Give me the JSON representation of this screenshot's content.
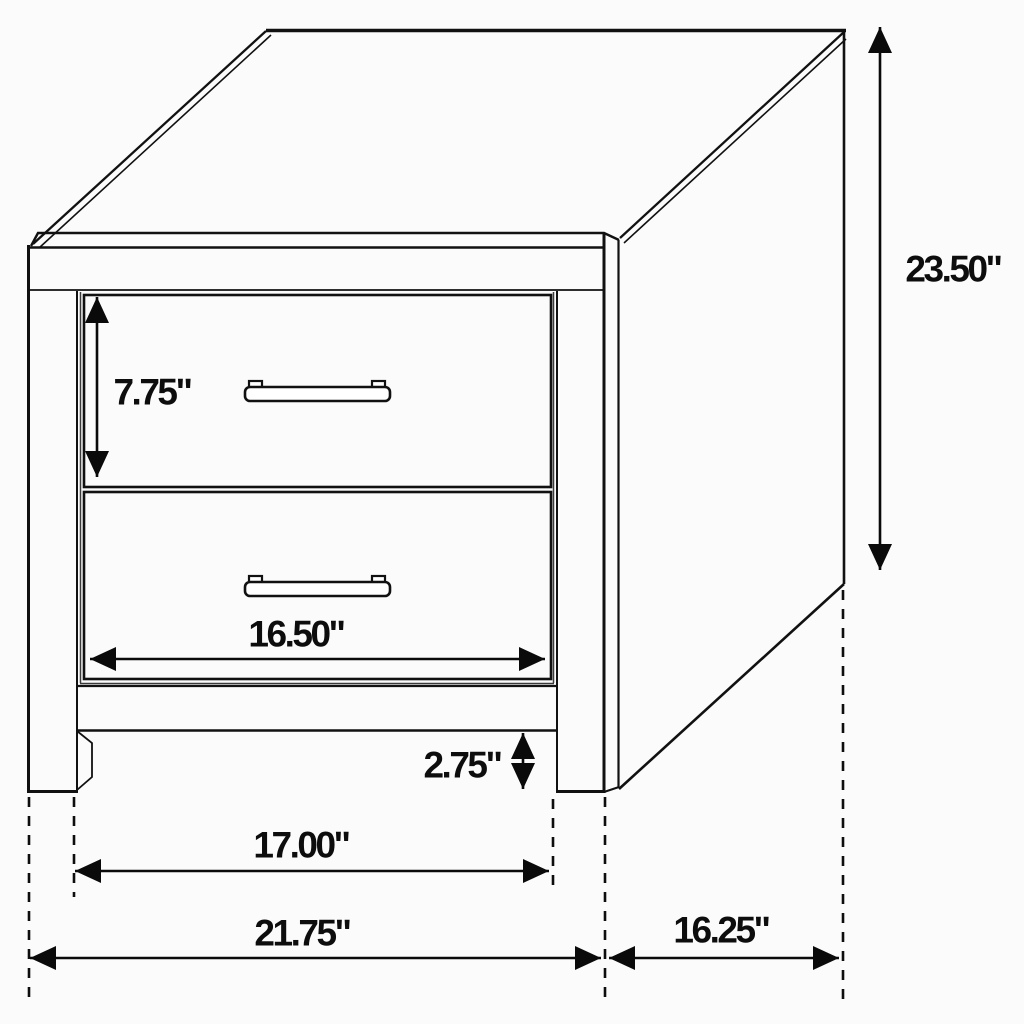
{
  "page": {
    "background": "#fbfbfb",
    "line_color": "#111111",
    "text_color": "#0d0d0d"
  },
  "diagram": {
    "subject": "nightstand with two drawers",
    "unit_suffix": "\"",
    "dimensions": {
      "overall_height": {
        "value": "23.50\""
      },
      "top_drawer_height": {
        "value": "7.75\""
      },
      "drawer_front_width": {
        "value": "16.50\""
      },
      "leg_height": {
        "value": "2.75\""
      },
      "inner_leg_span": {
        "value": "17.00\""
      },
      "overall_width": {
        "value": "21.75\""
      },
      "side_depth": {
        "value": "16.25\""
      }
    }
  }
}
